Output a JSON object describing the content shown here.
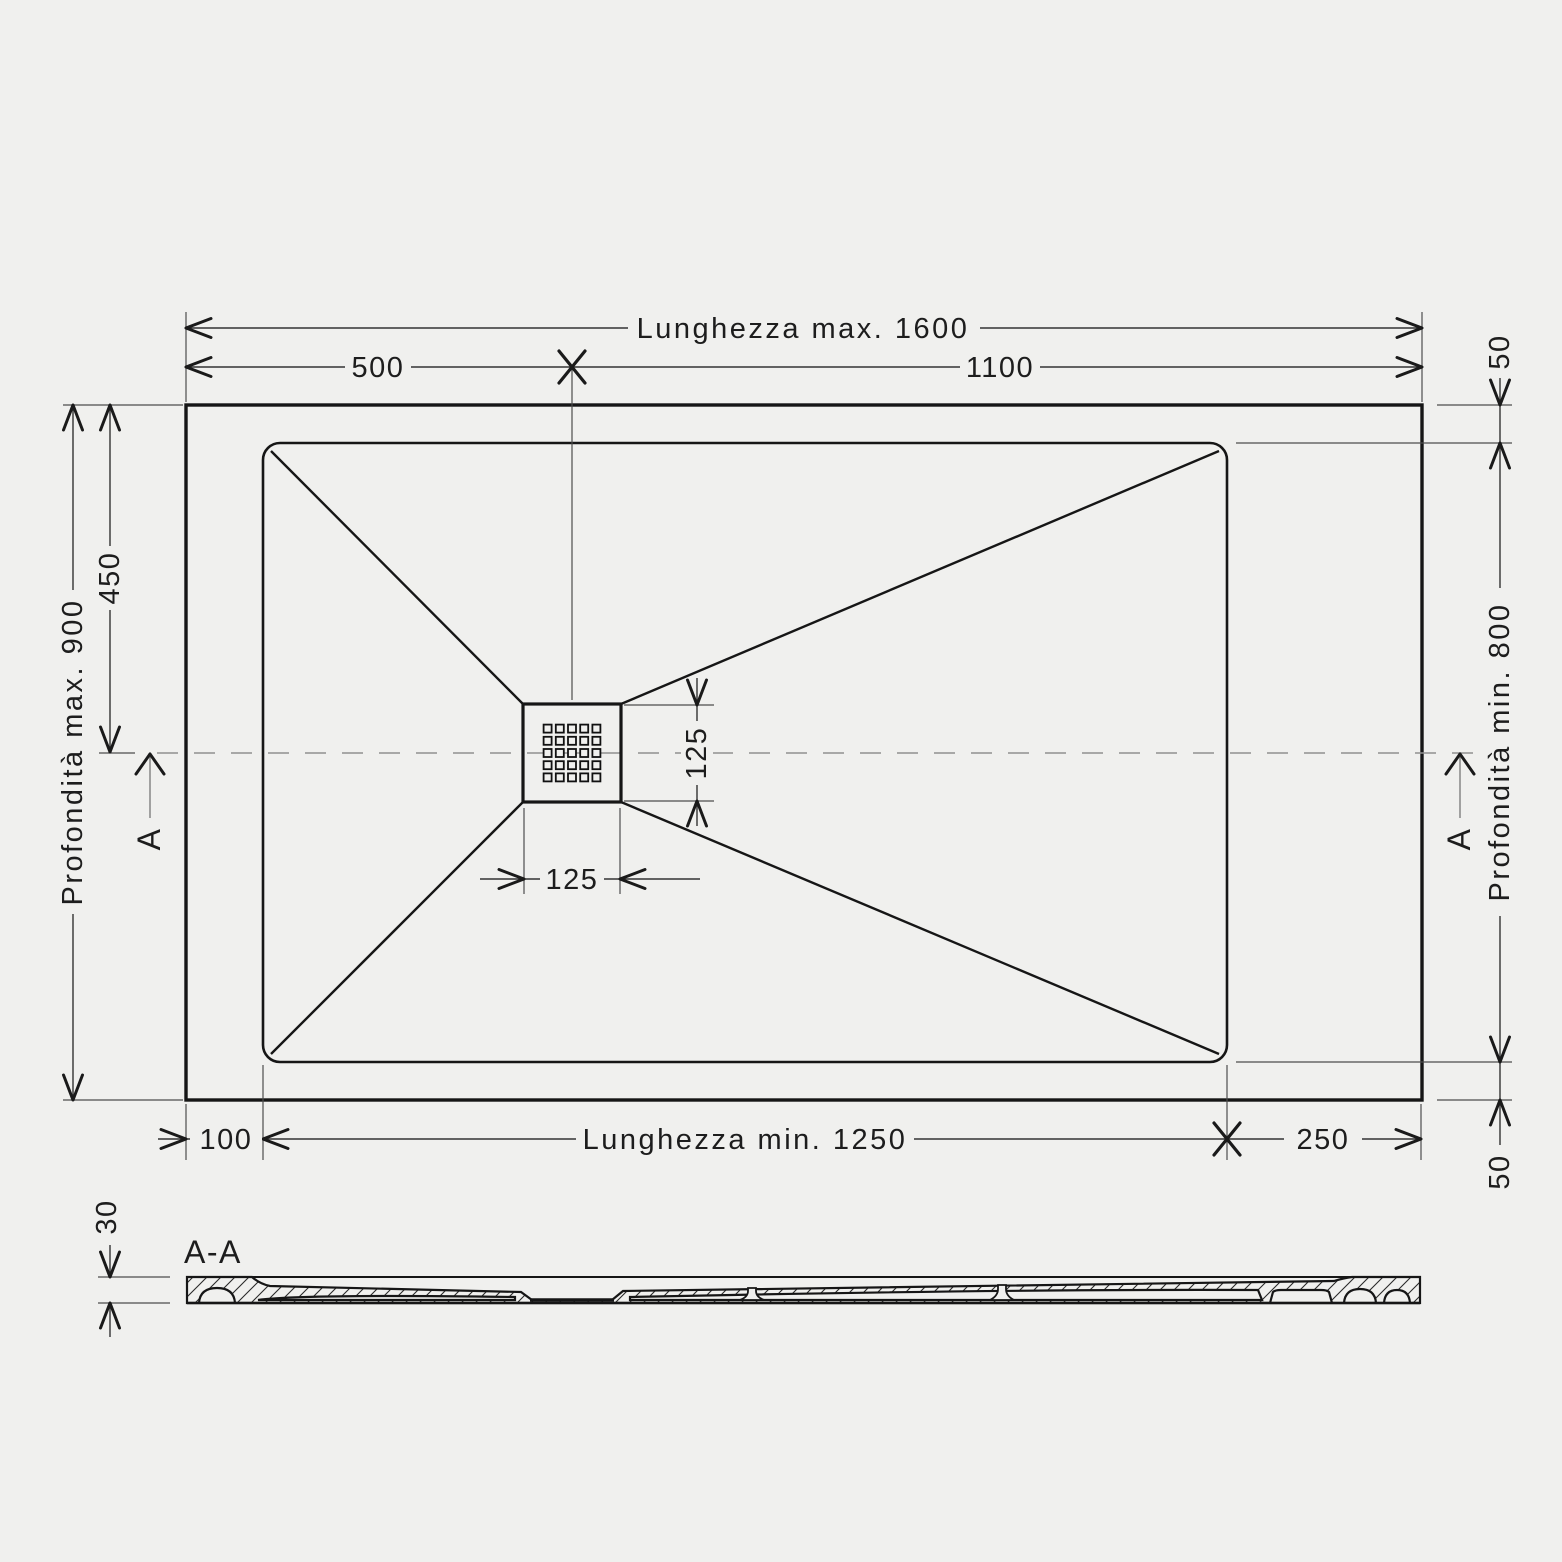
{
  "meta": {
    "background_color": "#f0f0ee",
    "line_color": "#161616",
    "drawing_type": "shower-tray technical drawing"
  },
  "plan": {
    "dim_length_max": "Lunghezza max. 1600",
    "dim_offset_left_top": "500",
    "dim_offset_right_top": "1100",
    "dim_rim_top_right": "50",
    "dim_depth_max": "Profondità max. 900",
    "dim_center_offset": "450",
    "dim_depth_min": "Profondità min. 800",
    "dim_drain_vertical": "125",
    "dim_drain_horizontal": "125",
    "dim_length_min": "Lunghezza min. 1250",
    "dim_rim_left": "100",
    "dim_rim_right": "250",
    "dim_rim_bottom_right": "50",
    "section_marker_left": "A",
    "section_marker_right": "A"
  },
  "section": {
    "label": "A-A",
    "dim_thickness": "30"
  }
}
